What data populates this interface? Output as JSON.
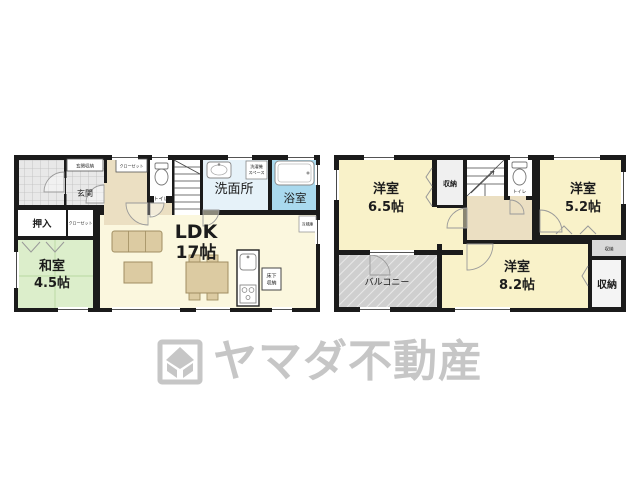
{
  "colors": {
    "wall": "#1b1b1b",
    "room_yellow": "#f9f2c9",
    "ldk_cream": "#fbf7de",
    "tatami_green": "#dceecb",
    "hall_beige": "#ebdfc2",
    "washroom_blue": "#e6f2f9",
    "bath_blue": "#a9d9ee",
    "balcony_gray": "#cfcfcf",
    "furniture_tan": "#dccba2",
    "logo_gray": "#c6c6c6"
  },
  "floor1": {
    "genkan": "玄関",
    "genkan_storage": "玄関収納",
    "closet_hall": "クローゼット",
    "closet_washitsu": "クローゼット",
    "oshiire": "押入",
    "washitsu_name": "和室",
    "washitsu_size": "4.5帖",
    "toilet": "トイレ",
    "washroom": "洗面所",
    "washer_line1": "洗濯機",
    "washer_line2": "スペース",
    "bath": "浴室",
    "ldk_name": "LDK",
    "ldk_size": "17帖",
    "underfloor_line1": "床下",
    "underfloor_line2": "収納",
    "fridge": "冷蔵庫"
  },
  "floor2": {
    "room65_name": "洋室",
    "room65_size": "6.5帖",
    "closet_left": "収納",
    "toilet": "トイレ",
    "room52_name": "洋室",
    "room52_size": "5.2帖",
    "balcony": "バルコニー",
    "room82_name": "洋室",
    "room82_size": "8.2帖",
    "closet_small": "収納",
    "closet_big": "収納"
  },
  "logo": {
    "brand": "ヤマダ不動産"
  }
}
